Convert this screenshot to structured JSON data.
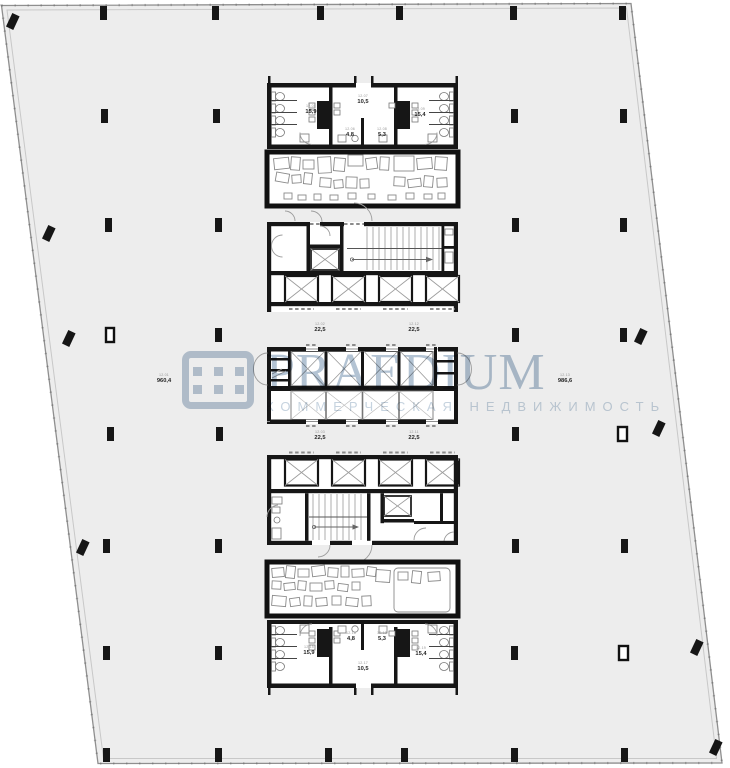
{
  "watermark": {
    "brand": "PRAEDIUM",
    "tagline": "КОММЕРЧЕСКАЯ НЕДВИЖИМОСТЬ",
    "accent_color": "#bcc9d7",
    "icon": "praedium-dots-logo"
  },
  "colors": {
    "floor_fill": "#ededed",
    "wall": "#161616",
    "slab_outline": "#8f8f8f",
    "label_value": "#262626",
    "label_code": "#9a9a9a"
  },
  "zones": {
    "main_left": {
      "code": "12.01",
      "area": "960,4"
    },
    "main_right": {
      "code": "12.13",
      "area": "986,6"
    },
    "upper_mid_left": {
      "code": "12.02",
      "area": "22,5"
    },
    "upper_mid_right": {
      "code": "12.12",
      "area": "22,5"
    },
    "lower_mid_left": {
      "code": "12.03",
      "area": "22,5"
    },
    "lower_mid_right": {
      "code": "12.11",
      "area": "22,5"
    }
  },
  "top_core_rooms": {
    "lobby": {
      "code": "12.07",
      "area": "10,5"
    },
    "wc_left": {
      "code": "12.05",
      "area": "15,9"
    },
    "wc_right": {
      "code": "12.09",
      "area": "15,4"
    },
    "aux_left": {
      "code": "12.06",
      "area": "4,8"
    },
    "aux_right": {
      "code": "12.08",
      "area": "5,3"
    }
  },
  "bottom_core_rooms": {
    "aux_left": {
      "code": "12.16",
      "area": "4,8"
    },
    "aux_right": {
      "code": "12.18",
      "area": "5,3"
    },
    "wc_left": {
      "code": "12.15",
      "area": "15,9"
    },
    "wc_right": {
      "code": "12.19",
      "area": "15,4"
    },
    "lobby": {
      "code": "12.17",
      "area": "10,5"
    }
  }
}
